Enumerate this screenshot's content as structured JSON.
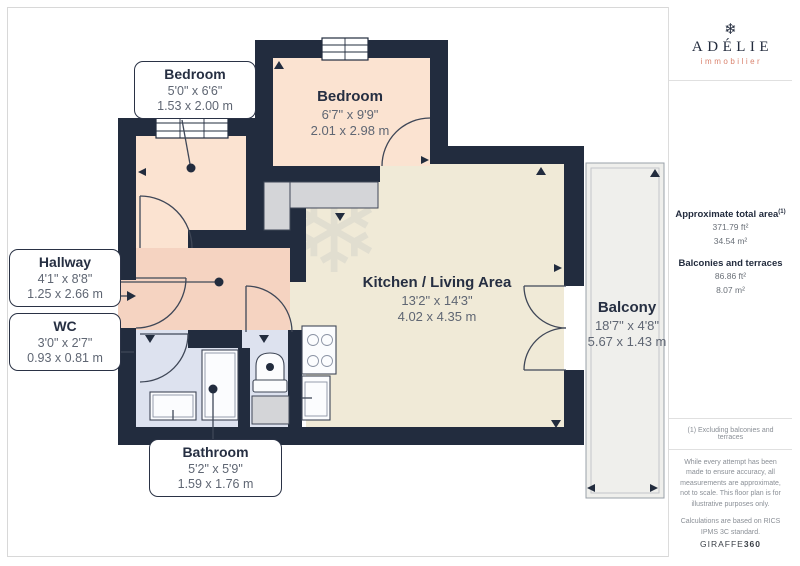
{
  "colors": {
    "wall": "#222c3e",
    "bedroom": "#fbe3d1",
    "hallway": "#f5d3c1",
    "living": "#f0ead7",
    "bath": "#dde2ef",
    "closet": "#d4d5d8",
    "balcony": "#efefec",
    "line": "#3f4757",
    "navy": "#232c3e",
    "coral": "#d9826d"
  },
  "sidebar": {
    "logo": {
      "glyph": "❄",
      "name": "ADÉLIE",
      "tagline": "immobilier"
    },
    "total_area": {
      "label": "Approximate total area",
      "superscript": "(1)",
      "ft": "371.79 ft²",
      "m": "34.54 m²"
    },
    "balconies": {
      "label": "Balconies and terraces",
      "ft": "86.86 ft²",
      "m": "8.07 m²"
    },
    "note": "(1) Excluding balconies and terraces",
    "disclaimer": "While every attempt has been made to ensure accuracy, all measurements are approximate, not to scale. This floor plan is for illustrative purposes only.",
    "calculations": "Calculations are based on RICS IPMS 3C standard.",
    "brand_footer": {
      "name": "GIRAFFE",
      "suffix": "360"
    }
  },
  "floorplan": {
    "watermark": {
      "title": "ADÉLIE",
      "subtitle": "immobilier",
      "glyph": "❄"
    },
    "rooms": {
      "bedroom_small": {
        "name": "Bedroom",
        "imperial": "5'0\" x 6'6\"",
        "metric": "1.53 x 2.00 m"
      },
      "bedroom_large": {
        "name": "Bedroom",
        "imperial": "6'7\" x 9'9\"",
        "metric": "2.01 x 2.98 m"
      },
      "kitchen_living": {
        "name": "Kitchen / Living Area",
        "imperial": "13'2\" x 14'3\"",
        "metric": "4.02 x 4.35 m"
      },
      "balcony": {
        "name": "Balcony",
        "imperial": "18'7\" x 4'8\"",
        "metric": "5.67 x 1.43 m"
      },
      "hallway": {
        "name": "Hallway",
        "imperial": "4'1\" x 8'8\"",
        "metric": "1.25 x 2.66 m"
      },
      "wc": {
        "name": "WC",
        "imperial": "3'0\" x 2'7\"",
        "metric": "0.93 x 0.81 m"
      },
      "bathroom": {
        "name": "Bathroom",
        "imperial": "5'2\" x 5'9\"",
        "metric": "1.59 x 1.76 m"
      }
    }
  }
}
